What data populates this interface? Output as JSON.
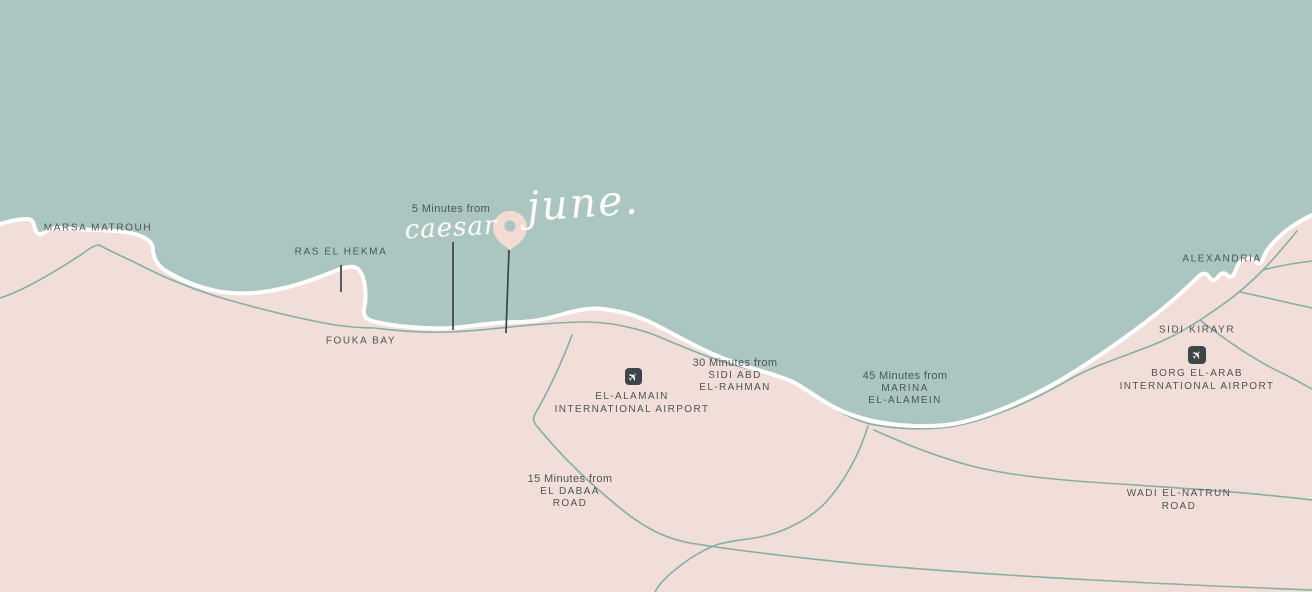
{
  "colors": {
    "sea": "#abc6c1",
    "land": "#f1ded8",
    "coastline": "#ffffff",
    "road": "#87aea4",
    "label": "#4e5456",
    "marker_line": "#3c4245",
    "icon_bg": "#3f4446",
    "icon_fg": "#ffffff",
    "pin": "#f3dad2",
    "script_text": "#ffffff"
  },
  "brand": {
    "project_name": "june.",
    "proximity_prefix": "5 Minutes from",
    "proximity_name": "caesar"
  },
  "icons": {
    "airplane_glyph": "✈",
    "location_pin": "map-pin"
  },
  "places": {
    "marsa_matrouh": "MARSA MATROUH",
    "ras_el_hekma": "RAS EL HEKMA",
    "fouka_bay": "FOUKA BAY",
    "alexandria": "ALEXANDRIA",
    "sidi_kirayr": "SIDI KIRAYR",
    "wadi_el_natrun": {
      "line1": "WADI EL-NATRUN",
      "line2": "ROAD"
    }
  },
  "airports": {
    "el_alamain": {
      "name_line1": "EL-ALAMAIN",
      "name_line2": "INTERNATIONAL AIRPORT"
    },
    "borg_el_arab": {
      "name_line1": "BORG EL-ARAB",
      "name_line2": "INTERNATIONAL AIRPORT"
    }
  },
  "distance_notes": {
    "sidi_abd_el_rahman": {
      "prefix": "30 Minutes from",
      "line1": "SIDI ABD",
      "line2": "EL-RAHMAN"
    },
    "marina_el_alamein": {
      "prefix": "45 Minutes from",
      "line1": "MARINA",
      "line2": "EL-ALAMEIN"
    },
    "el_dabaa_road": {
      "prefix": "15 Minutes from",
      "line1": "EL DABAA",
      "line2": "ROAD"
    }
  }
}
